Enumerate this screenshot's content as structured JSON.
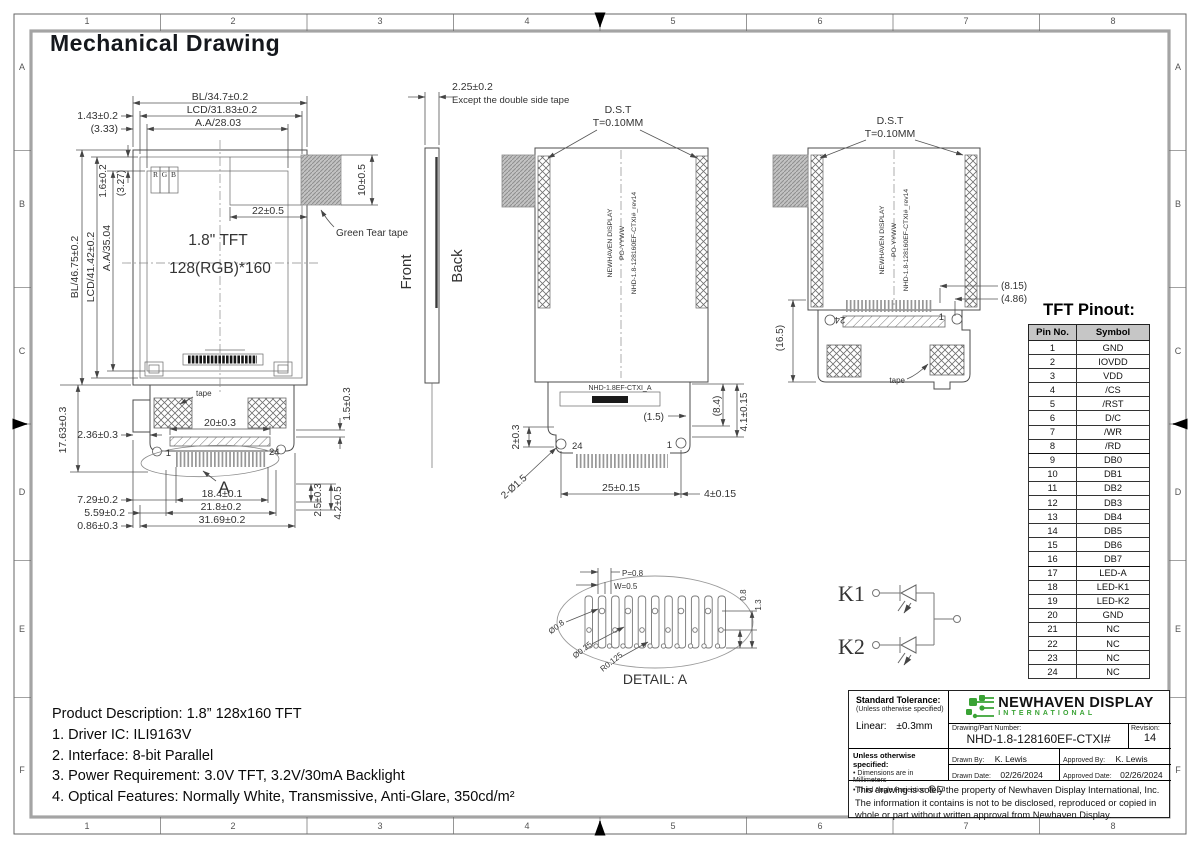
{
  "page": {
    "title": "Mechanical Drawing"
  },
  "colors": {
    "logo_green": "#3aa335",
    "pinout_header_bg": "#c6c6c6",
    "line": "#4d4d4d"
  },
  "frame": {
    "cols": [
      "1",
      "2",
      "3",
      "4",
      "5",
      "6",
      "7",
      "8"
    ],
    "rows": [
      "A",
      "B",
      "C",
      "D",
      "E",
      "F"
    ]
  },
  "front_view": {
    "size_label": "1.8\" TFT",
    "res_label": "128(RGB)*160",
    "rgb_r": "R",
    "rgb_g": "G",
    "rgb_b": "B",
    "dim_bl_w": "BL/34.7±0.2",
    "dim_lcd_w": "LCD/31.83±0.2",
    "dim_aa_w": "A.A/28.03",
    "dim_left_offset": "1.43±0.2",
    "dim_left_offset_ref": "(3.33)",
    "dim_top_gap": "1.6±0.2",
    "dim_top_gap_ref": "(3.27)",
    "dim_bl_h": "BL/46.75±0.2",
    "dim_lcd_h": "LCD/41.42±0.2",
    "dim_aa_h": "A.A/35.04",
    "dim_tape_h": "10±0.5",
    "dim_tape_w": "22±0.5",
    "tape_callout": "Green Tear tape",
    "fpc_tape_label": "tape",
    "dim_fpc_len": "17.63±0.3",
    "dim_fpc_offset": "2.36±0.3",
    "dim_stiffener": "20±0.3",
    "dim_right_gap": "1.5±0.3",
    "dim_729": "7.29±0.2",
    "dim_184": "18.4±0.1",
    "dim_559": "5.59±0.2",
    "dim_218": "21.8±0.2",
    "dim_086": "0.86±0.3",
    "dim_3169": "31.69±0.2",
    "dim_25v": "2.5±0.3",
    "dim_42v": "4.2±0.5",
    "pin_1": "1",
    "pin_24": "24",
    "detail_ref": "A"
  },
  "side_view": {
    "dim_thickness": "2.25±0.2",
    "thickness_note": "Except the double side tape",
    "front_label": "Front",
    "back_label": "Back"
  },
  "back_view": {
    "dst_label": "D.S.T",
    "dst_thickness": "T=0.10MM",
    "marking_1": "NEWHAVEN DISPLAY",
    "marking_2": "PO-YYWW",
    "marking_3": "NHD-1.8-128160EF-CTXI#_rev14",
    "model_label": "NHD-1.8EF-CTXI_A",
    "pin_24": "24",
    "pin_1": "1",
    "dim_hole_edge": "2±0.3",
    "dim_holes": "2-Ø1.5",
    "dim_conn_w": "25±0.15",
    "dim_conn_r": "4±0.15",
    "dim_15": "(1.5)",
    "dim_84": "(8.4)",
    "dim_41": "4.1±0.15"
  },
  "back_view2": {
    "dst_label": "D.S.T",
    "dst_thickness": "T=0.10MM",
    "marking_1": "NEWHAVEN DISPLAY",
    "marking_2": "PO-YYWW",
    "marking_3": "NHD-1.8-128160EF-CTXI#_rev14",
    "dim_815": "(8.15)",
    "dim_486": "(4.86)",
    "dim_165": "(16.5)",
    "pin_24": "24",
    "pin_1": "1",
    "tape_label": "tape"
  },
  "detail_a": {
    "title": "DETAIL: A",
    "dim_pitch": "P=0.8",
    "dim_width": "W=0.5",
    "dim_08": "0.8",
    "dim_13": "1.3",
    "dim_d08": "Ø0.8",
    "dim_d025": "Ø0.25",
    "dim_r0125": "R0.125"
  },
  "led_circuit": {
    "k1": "K1",
    "k2": "K2",
    "anode": "A"
  },
  "pinout": {
    "title": "TFT Pinout:",
    "headers": [
      "Pin No.",
      "Symbol"
    ],
    "rows": [
      [
        "1",
        "GND"
      ],
      [
        "2",
        "IOVDD"
      ],
      [
        "3",
        "VDD"
      ],
      [
        "4",
        "/CS"
      ],
      [
        "5",
        "/RST"
      ],
      [
        "6",
        "D/C"
      ],
      [
        "7",
        "/WR"
      ],
      [
        "8",
        "/RD"
      ],
      [
        "9",
        "DB0"
      ],
      [
        "10",
        "DB1"
      ],
      [
        "11",
        "DB2"
      ],
      [
        "12",
        "DB3"
      ],
      [
        "13",
        "DB4"
      ],
      [
        "14",
        "DB5"
      ],
      [
        "15",
        "DB6"
      ],
      [
        "16",
        "DB7"
      ],
      [
        "17",
        "LED-A"
      ],
      [
        "18",
        "LED-K1"
      ],
      [
        "19",
        "LED-K2"
      ],
      [
        "20",
        "GND"
      ],
      [
        "21",
        "NC"
      ],
      [
        "22",
        "NC"
      ],
      [
        "23",
        "NC"
      ],
      [
        "24",
        "NC"
      ]
    ]
  },
  "product": {
    "line1": "Product Description: 1.8” 128x160 TFT",
    "line2": "1. Driver IC: ILI9163V",
    "line3": "2. Interface: 8-bit Parallel",
    "line4": "3. Power Requirement: 3.0V TFT, 3.2V/30mA Backlight",
    "line5": "4. Optical Features: Normally White, Transmissive, Anti-Glare, 350cd/m²"
  },
  "title_block": {
    "std_tol_title": "Standard Tolerance:",
    "std_tol_sub": "(Unless otherwise specified)",
    "linear_label": "Linear:",
    "linear_value": "±0.3mm",
    "uos_title": "Unless otherwise specified:",
    "uos_item1": "Dimensions are in Millimeters",
    "uos_item2": "Third Angle Projection",
    "company": "NEWHAVEN DISPLAY",
    "company_sub": "INTERNATIONAL",
    "part_label": "Drawing/Part Number:",
    "part_number": "NHD-1.8-128160EF-CTXI#",
    "rev_label": "Revision:",
    "revision": "14",
    "drawn_by_label": "Drawn By:",
    "drawn_by": "K. Lewis",
    "approved_by_label": "Approved By:",
    "approved_by": "K. Lewis",
    "drawn_date_label": "Drawn Date:",
    "drawn_date": "02/26/2024",
    "approved_date_label": "Approved Date:",
    "approved_date": "02/26/2024",
    "legal_1": "This drawing is solely the property of Newhaven Display International, Inc.",
    "legal_2": "The information it contains is not to be disclosed, reproduced or copied in",
    "legal_3": "whole or part without written approval from Newhaven Display."
  }
}
